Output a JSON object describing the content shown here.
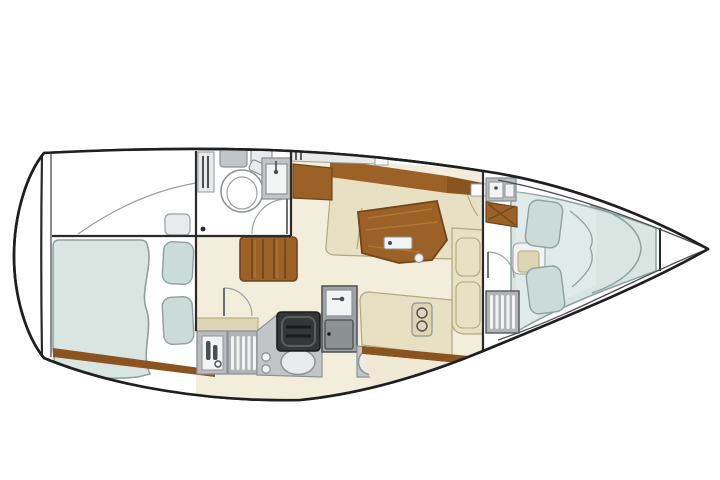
{
  "figure": {
    "kind": "sailboat-interior-floor-plan",
    "view": "top-down",
    "bow_direction": "right",
    "features": [
      "hull-outline",
      "transom",
      "anchor-locker",
      "aft-double-berth",
      "berth-pillows",
      "head-compartment",
      "toilet",
      "head-sink",
      "head-shelves",
      "door-swing-arcs",
      "companionway-steps",
      "galley-bottle-locker",
      "galley-louvered-locker",
      "galley-stove",
      "galley-fridge-unit",
      "galley-oval-sink",
      "galley-double-sink",
      "salon-table",
      "port-l-settee",
      "starboard-settee",
      "forward-seat-chest",
      "wood-sideboard",
      "side-shelf",
      "forward-vanity-unit",
      "wood-cross-cabinet",
      "forward-louvered-locker",
      "v-berth",
      "v-berth-pillows",
      "blanket-curl-lines"
    ]
  },
  "palette": {
    "paper": "#ffffff",
    "hull_line": "#1f1f1f",
    "wall_line": "#2a2a2a",
    "line": "#8d9294",
    "soft_line": "#9aa0a2",
    "floor": "#f3eedc",
    "floor_deep": "#efe9d6",
    "white": "#ffffff",
    "off_white": "#f2f3f3",
    "shelf": "#e9eaeb",
    "berth": "#d8e5e1",
    "berth_light": "#e4eeeb",
    "berth_line": "#8da09f",
    "pillow": "#cbdcd8",
    "cushion": "#e8e0c2",
    "cushion_dark": "#ded5b4",
    "cushion_line": "#b2a77f",
    "wood": "#9c6126",
    "wood_dark": "#6f4519",
    "wood_mid": "#8a5420",
    "wood_light": "#b07a36",
    "counter": "#c2c5c7",
    "counter_dark": "#9ea3a5",
    "unit_gray": "#b9bdbf",
    "unit_mid": "#b0b4b6",
    "door_gray": "#8b9092",
    "appliance": "#343637",
    "appliance_dark": "#191b1c",
    "appliance_hi": "#5a5f60",
    "glyph_dark": "#4a4e50"
  }
}
